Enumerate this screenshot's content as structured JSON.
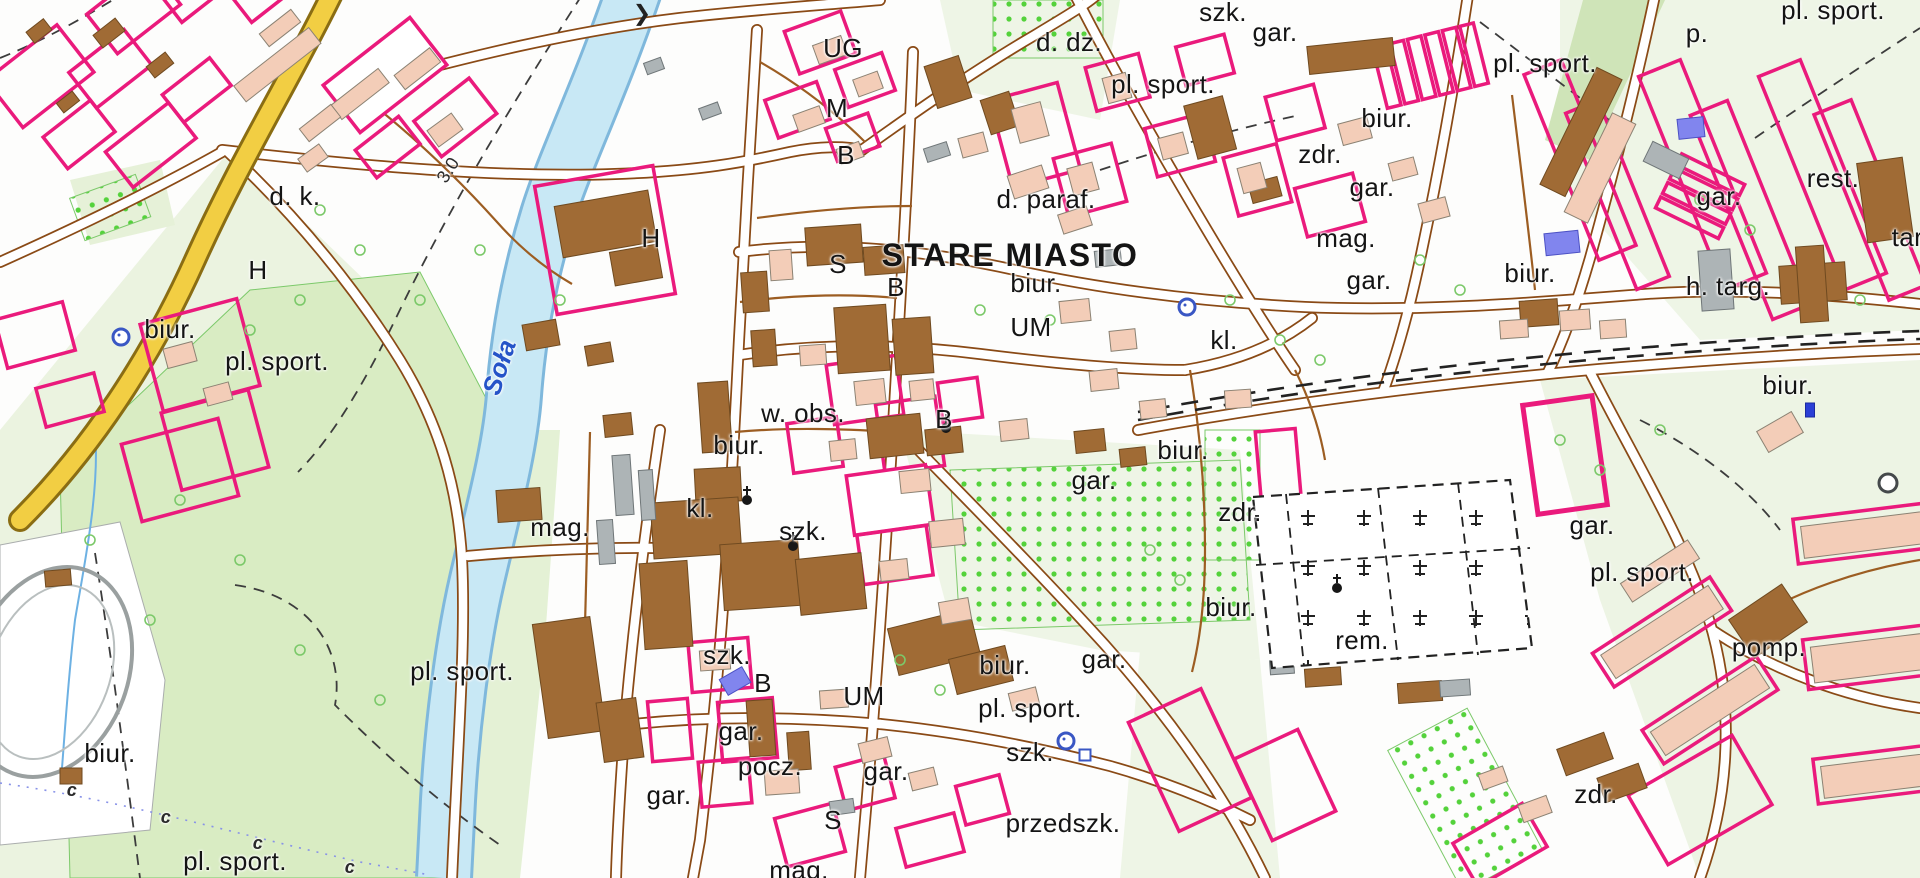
{
  "map": {
    "place_name": "STARE MIASTO",
    "river_name": "Soła",
    "colors": {
      "parcel_pink": "#ea1a7c",
      "road_casing_brown": "#8a4a16",
      "minor_path_brown": "#9c5d22",
      "highway_yellow": "#f2ce43",
      "river_fill": "#c8e8f5",
      "river_edge": "#7fb8dc",
      "meadow_green": "#d9ecc3",
      "pale_green": "#ebf3e0",
      "orchard_dot_green": "#54d23b",
      "building_brown": "#a06b35",
      "building_salmon": "#f3cdb8",
      "building_gray": "#adb4b6",
      "building_blue": "#8185ee",
      "railway_black": "#222222",
      "label_black": "#141414",
      "water_label_blue": "#2553c8"
    },
    "labels": [
      {
        "text": "d. k.",
        "x": 295,
        "y": 196
      },
      {
        "text": "H",
        "x": 258,
        "y": 270
      },
      {
        "text": "biur.",
        "x": 170,
        "y": 329
      },
      {
        "text": "pl. sport.",
        "x": 277,
        "y": 361
      },
      {
        "text": "Soła",
        "x": 499,
        "y": 367,
        "cls": "water",
        "rot": -72
      },
      {
        "text": "3.0",
        "x": 448,
        "y": 170,
        "cls": "small",
        "rot": -58
      },
      {
        "text": "mag.",
        "x": 560,
        "y": 527
      },
      {
        "text": "pl. sport.",
        "x": 462,
        "y": 671
      },
      {
        "text": "biur.",
        "x": 110,
        "y": 753
      },
      {
        "text": "pl. sport.",
        "x": 235,
        "y": 861
      },
      {
        "text": "UG",
        "x": 843,
        "y": 48
      },
      {
        "text": "M",
        "x": 837,
        "y": 108
      },
      {
        "text": "B",
        "x": 846,
        "y": 155
      },
      {
        "text": "H",
        "x": 651,
        "y": 238
      },
      {
        "text": "S",
        "x": 838,
        "y": 264
      },
      {
        "text": "B",
        "x": 896,
        "y": 287
      },
      {
        "text": "STARE MIASTO",
        "x": 1010,
        "y": 255,
        "cls": "place"
      },
      {
        "text": "biur.",
        "x": 1036,
        "y": 283
      },
      {
        "text": "UM",
        "x": 1031,
        "y": 327
      },
      {
        "text": "d. paraf.",
        "x": 1046,
        "y": 199
      },
      {
        "text": "d. dz.",
        "x": 1069,
        "y": 42
      },
      {
        "text": "pl. sport.",
        "x": 1163,
        "y": 84
      },
      {
        "text": "szk.",
        "x": 1223,
        "y": 12
      },
      {
        "text": "gar.",
        "x": 1275,
        "y": 32
      },
      {
        "text": "biur.",
        "x": 1387,
        "y": 118
      },
      {
        "text": "zdr.",
        "x": 1320,
        "y": 154
      },
      {
        "text": "gar.",
        "x": 1372,
        "y": 187
      },
      {
        "text": "mag.",
        "x": 1346,
        "y": 238
      },
      {
        "text": "gar.",
        "x": 1369,
        "y": 280
      },
      {
        "text": "biur.",
        "x": 1530,
        "y": 273
      },
      {
        "text": "kl.",
        "x": 1224,
        "y": 340
      },
      {
        "text": "pl. sport.",
        "x": 1545,
        "y": 63
      },
      {
        "text": "pl. sport.",
        "x": 1833,
        "y": 10
      },
      {
        "text": "p.",
        "x": 1697,
        "y": 33
      },
      {
        "text": "gar.",
        "x": 1719,
        "y": 196
      },
      {
        "text": "rest.",
        "x": 1833,
        "y": 178
      },
      {
        "text": "tart.",
        "x": 1915,
        "y": 237
      },
      {
        "text": "h. targ.",
        "x": 1728,
        "y": 286
      },
      {
        "text": "biur.",
        "x": 1788,
        "y": 385
      },
      {
        "text": "w. obs.",
        "x": 803,
        "y": 413
      },
      {
        "text": "biur.",
        "x": 739,
        "y": 445
      },
      {
        "text": "kl.",
        "x": 700,
        "y": 508
      },
      {
        "text": "szk.",
        "x": 803,
        "y": 531
      },
      {
        "text": "B",
        "x": 944,
        "y": 419
      },
      {
        "text": "gar.",
        "x": 1094,
        "y": 480
      },
      {
        "text": "biur.",
        "x": 1183,
        "y": 450
      },
      {
        "text": "zdr.",
        "x": 1240,
        "y": 512
      },
      {
        "text": "biur.",
        "x": 1231,
        "y": 607
      },
      {
        "text": "rem.",
        "x": 1362,
        "y": 640
      },
      {
        "text": "gar.",
        "x": 1592,
        "y": 525
      },
      {
        "text": "pl. sport.",
        "x": 1642,
        "y": 572
      },
      {
        "text": "pomp.",
        "x": 1769,
        "y": 647
      },
      {
        "text": "zdr.",
        "x": 1596,
        "y": 794
      },
      {
        "text": "szk.",
        "x": 727,
        "y": 655
      },
      {
        "text": "B",
        "x": 763,
        "y": 683
      },
      {
        "text": "UM",
        "x": 864,
        "y": 696
      },
      {
        "text": "gar.",
        "x": 741,
        "y": 731
      },
      {
        "text": "pocz.",
        "x": 770,
        "y": 766
      },
      {
        "text": "gar.",
        "x": 886,
        "y": 771
      },
      {
        "text": "S",
        "x": 833,
        "y": 820
      },
      {
        "text": "mag.",
        "x": 799,
        "y": 870
      },
      {
        "text": "gar.",
        "x": 669,
        "y": 795
      },
      {
        "text": "biur.",
        "x": 1005,
        "y": 665
      },
      {
        "text": "gar.",
        "x": 1104,
        "y": 659
      },
      {
        "text": "pl. sport.",
        "x": 1030,
        "y": 708
      },
      {
        "text": "szk.",
        "x": 1030,
        "y": 752
      },
      {
        "text": "przedszk.",
        "x": 1063,
        "y": 823
      },
      {
        "text": "c",
        "x": 72,
        "y": 790,
        "cls": "water small"
      },
      {
        "text": "c",
        "x": 166,
        "y": 817,
        "cls": "water small"
      },
      {
        "text": "c",
        "x": 258,
        "y": 843,
        "cls": "water small"
      },
      {
        "text": "c",
        "x": 350,
        "y": 867,
        "cls": "water small"
      }
    ],
    "symbols": [
      {
        "type": "fountain",
        "x": 1187,
        "y": 307
      },
      {
        "type": "fountain",
        "x": 121,
        "y": 337
      },
      {
        "type": "fountain",
        "x": 1066,
        "y": 741
      },
      {
        "type": "well",
        "x": 1085,
        "y": 755
      },
      {
        "type": "roundabout",
        "x": 1888,
        "y": 483
      },
      {
        "type": "church",
        "x": 747,
        "y": 500
      },
      {
        "type": "church",
        "x": 793,
        "y": 546
      },
      {
        "type": "church",
        "x": 946,
        "y": 428
      },
      {
        "type": "church",
        "x": 1337,
        "y": 588
      },
      {
        "type": "monument",
        "x": 1810,
        "y": 410
      },
      {
        "type": "flow-arrow",
        "x": 642,
        "y": 14
      }
    ]
  }
}
